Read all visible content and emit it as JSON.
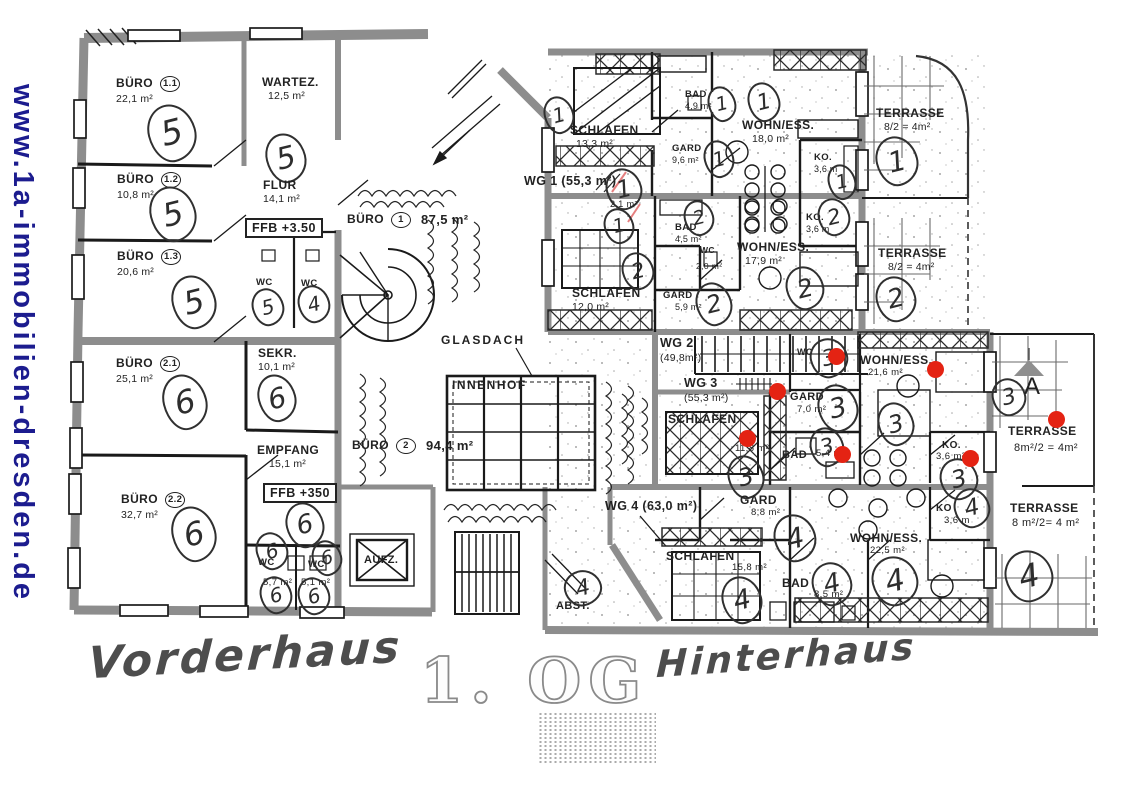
{
  "watermark": {
    "url": "www.1a-immobilien-dresden.de"
  },
  "captions": {
    "front_house": "Vorderhaus",
    "floor": "1. OG",
    "rear_house": "Hinterhaus"
  },
  "marks": {
    "u1": "1",
    "u2": "2",
    "u3": "3",
    "u3a_letter": "A",
    "u4": "4",
    "u5": "5",
    "u6": "6"
  },
  "vorderhaus": {
    "buero11": {
      "name": "BÜRO",
      "num": "1.1",
      "area": "22,1 m²"
    },
    "wartez": {
      "name": "WARTEZ.",
      "area": "12,5 m²"
    },
    "buero12": {
      "name": "BÜRO",
      "num": "1.2",
      "area": "10,8 m²"
    },
    "flur": {
      "name": "FLUR",
      "area": "14,1 m²"
    },
    "ffb_top": "FFB +3.50",
    "buero13": {
      "name": "BÜRO",
      "num": "1.3",
      "area": "20,6 m²"
    },
    "wc_upper_left": "WC",
    "wc_upper_right": "WC",
    "buero21": {
      "name": "BÜRO",
      "num": "2.1",
      "area": "25,1 m²"
    },
    "sekr": {
      "name": "SEKR.",
      "area": "10,1 m²"
    },
    "empfang": {
      "name": "EMPFANG",
      "area": "15,1 m²"
    },
    "ffb_bottom": "FFB +350",
    "buero22": {
      "name": "BÜRO",
      "num": "2.2",
      "area": "32,7 m²"
    },
    "wc_lower_left": {
      "name": "WC",
      "area": "5,7 m²"
    },
    "wc_lower_right": {
      "name": "WC",
      "area": "5,1 m²"
    },
    "aufzug": "AUFZ.",
    "abstell": "ABST.",
    "buero_1": {
      "name": "BÜRO",
      "num": "1",
      "area": "87,5 m²"
    },
    "buero_2": {
      "name": "BÜRO",
      "num": "2",
      "area": "94,4 m²"
    },
    "glasdach": "GLASDACH",
    "innenhof": "INNENHOF"
  },
  "hinterhaus": {
    "wg1": {
      "label": "WG 1 (55,3 m²)",
      "schlafen": {
        "name": "SCHLAFEN",
        "area": "13,3 m²"
      },
      "bad": {
        "name": "BAD",
        "area": "4,9 m²"
      },
      "wohness": {
        "name": "WOHN/ESS.",
        "area": "18,0 m²"
      },
      "gard": {
        "name": "GARD",
        "area": "9,6 m²"
      },
      "ko": {
        "name": "KO.",
        "area": "3,6 m"
      },
      "wc_area": "2,1 m²",
      "terrasse": {
        "name": "TERRASSE",
        "area": "8/2 = 4m²"
      }
    },
    "wg2": {
      "label": "WG 2",
      "label_area": "(49,8m²)",
      "schlafen": {
        "name": "SCHLAFEN",
        "area": "12,0 m²"
      },
      "bad": {
        "name": "BAD",
        "area": "4,5 m²"
      },
      "wc": {
        "name": "WC",
        "area": "2,0 m²"
      },
      "gard": {
        "name": "GARD",
        "area": "5,9 m²"
      },
      "wohness": {
        "name": "WOHN/ESS.",
        "area": "17,9 m²"
      },
      "ko": {
        "name": "KO.",
        "area": "3,6 m"
      },
      "terrasse": {
        "name": "TERRASSE",
        "area": "8/2 = 4m²"
      }
    },
    "wg3": {
      "label": "WG 3",
      "label_area": "(55,3 m²)",
      "schlafen": {
        "name": "SCHLAFEN",
        "area": "11,8 m²"
      },
      "gard": {
        "name": "GARD",
        "area": "7,0 m²"
      },
      "bad": {
        "name": "BAD",
        "area": "5,4 m²"
      },
      "wohness": {
        "name": "WOHN/ESS.",
        "area": "21,6 m²"
      },
      "ko": {
        "name": "KO.",
        "area": "3,6 m²"
      },
      "wc": "WC",
      "terrasse": {
        "name": "TERRASSE",
        "area": "8m²/2 = 4m²"
      }
    },
    "wg4": {
      "label": "WG 4 (63,0 m²)",
      "gard": {
        "name": "GARD",
        "area": "8,8 m²"
      },
      "schlafen": {
        "name": "SCHLAFEN",
        "area": "15,8 m²"
      },
      "bad": {
        "name": "BAD",
        "area": "8,5 m²"
      },
      "wohness": {
        "name": "WOHN/ESS.",
        "area": "22,5 m²"
      },
      "ko": {
        "name": "KO",
        "area": "3,6 m"
      },
      "terrasse": {
        "name": "TERRASSE",
        "area": "8 m²/2= 4 m²"
      }
    }
  },
  "colors": {
    "watermark_blue": "#1c1c8f",
    "marker_red": "#e42313",
    "wall_gray": "#8d8d8d",
    "ink": "#1f1f1f"
  }
}
